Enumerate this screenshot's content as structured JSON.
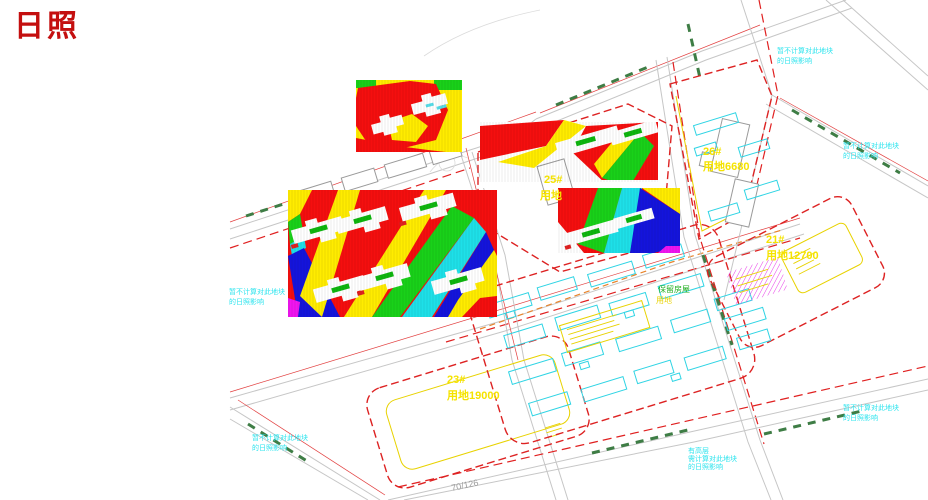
{
  "title": "日照",
  "parcels": {
    "p26": {
      "no": "26#",
      "area": "用地6680"
    },
    "p21": {
      "no": "21#",
      "area": "用地12700"
    },
    "p23": {
      "no": "23#",
      "area": "用地19000"
    },
    "p25": {
      "no": "25#",
      "area": "用地"
    }
  },
  "notes": [
    {
      "lines": [
        "暂不计算对此地块",
        "的日照影响"
      ]
    },
    {
      "lines": [
        "暂不计算对此地块",
        "的日照影响"
      ]
    },
    {
      "lines": [
        "暂不计算对此地块",
        "的日照影响"
      ]
    },
    {
      "lines": [
        "暂不计算对此地块",
        "的日照影响"
      ]
    },
    {
      "lines": [
        "暂不计算对此地块",
        "的日照影响"
      ]
    },
    {
      "lines": [
        "有高层",
        "需计算对此地块",
        "的日照影响"
      ]
    }
  ],
  "labels": {
    "retained": "保留房屋",
    "retained_area": "用地",
    "station": "70/126"
  },
  "colors": {
    "analysis_red": "#f50f0f",
    "analysis_yellow": "#ffec00",
    "analysis_green": "#19d119",
    "analysis_cyan": "#1ee0e8",
    "analysis_blue": "#1414dc",
    "analysis_magenta": "#f014f0",
    "note_cyan": "#2de4ee",
    "parcel_label_yellow": "#f5e300",
    "boundary_red": "#dd2222",
    "title_red": "#c40f0f",
    "road_green": "#3e7d45"
  }
}
